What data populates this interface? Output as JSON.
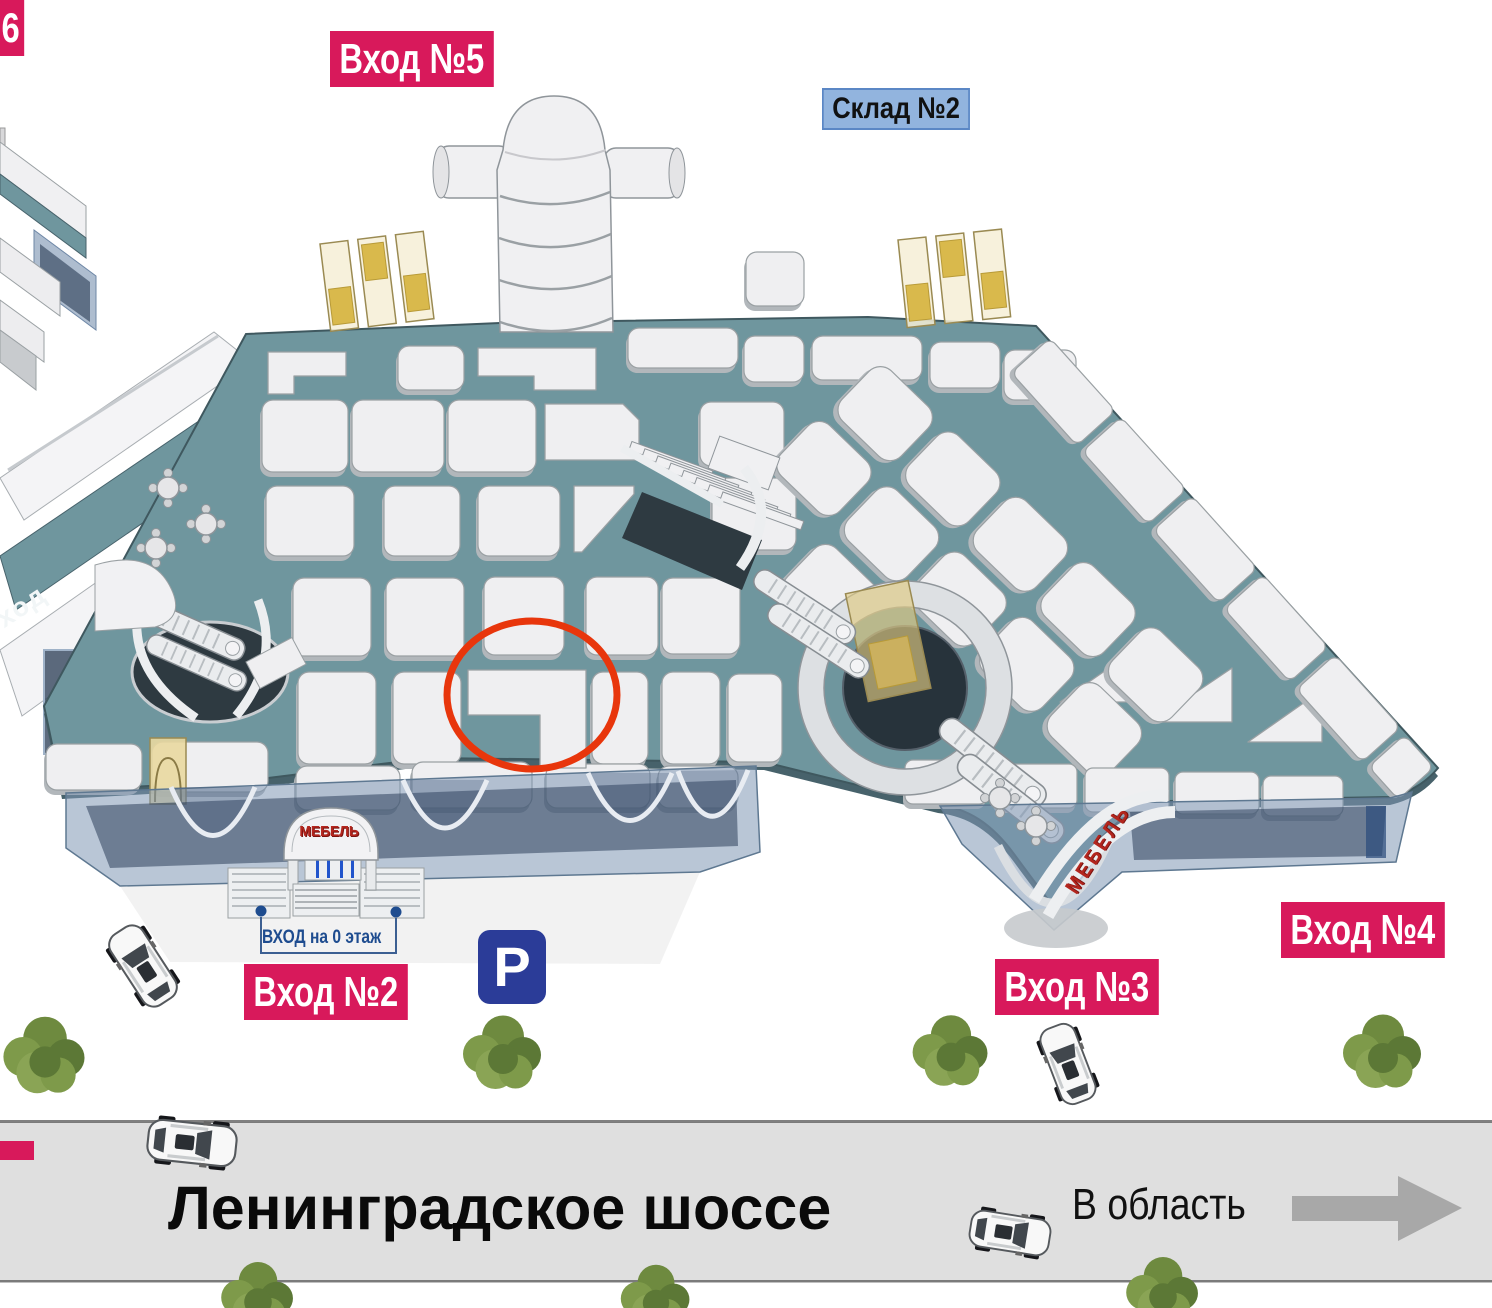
{
  "labels": {
    "entrance6_partial": "6",
    "entrance5": "Вход №5",
    "entrance2": "Вход №2",
    "entrance3": "Вход №3",
    "entrance4": "Вход №4",
    "warehouse2": "Склад №2",
    "ground_floor_entrance": "ВХОД на 0 этаж",
    "parking": "P",
    "walkway_partial": "ход"
  },
  "road": {
    "name": "Ленинградское шоссе",
    "direction": "В область"
  },
  "signs": {
    "mebel_entrance2": "МЕБЕЛЬ",
    "mebel_entrance3": "МЕБЕЛЬ"
  },
  "colors": {
    "accent-pink": "#D8195B",
    "label-blue-bg": "#92B4DE",
    "label-blue-border": "#5B87C5",
    "parking-blue": "#2B3C98",
    "deck-teal": "#6F969E",
    "deck-edge": "#47626B",
    "pad-fill": "#EFEFF1",
    "pad-stroke": "#9AA0A3",
    "road-gray": "#DFDFDF",
    "arrow-gray": "#A8A8A8",
    "highlight-red": "#E8360C",
    "sign-red": "#B3261E",
    "annotation-navy": "#1E4C8F"
  }
}
